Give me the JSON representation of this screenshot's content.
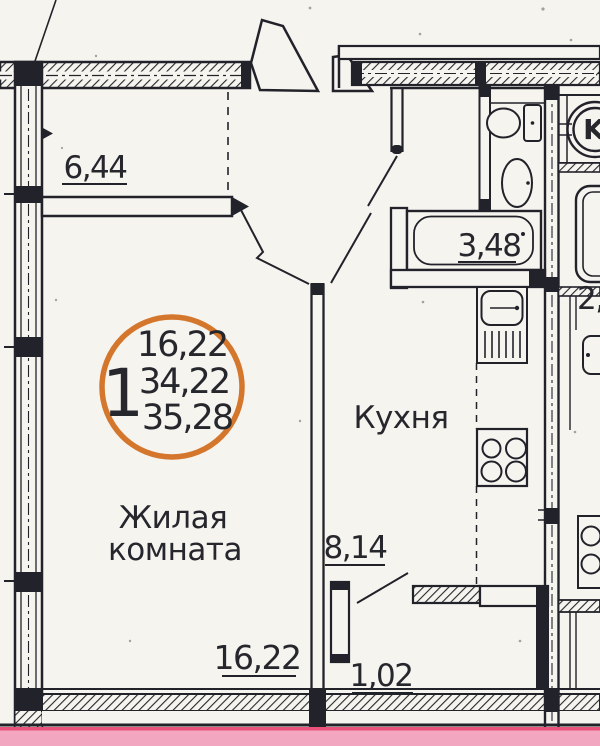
{
  "plan_title": "1-room apartment floor plan (scanned)",
  "badge": {
    "unit_number": "1",
    "area_line1": "16,22",
    "area_line2": "34,22",
    "area_line3": "35,28"
  },
  "rooms": {
    "living_line1": "Жилая",
    "living_line2": "комната",
    "kitchen": "Кухня"
  },
  "dims": {
    "balcony": "6,44",
    "bath": "3,48",
    "kitchen": "8,14",
    "living": "16,22",
    "hall": "1,02",
    "neighbor": "2,"
  },
  "vent_shaft": "K",
  "colors": {
    "paper": "#f6f4ef",
    "ink": "#22222a",
    "badge_orange": "#d4772c",
    "pink_strip": "#f2a6c0",
    "pink_edge": "#e8527b"
  }
}
